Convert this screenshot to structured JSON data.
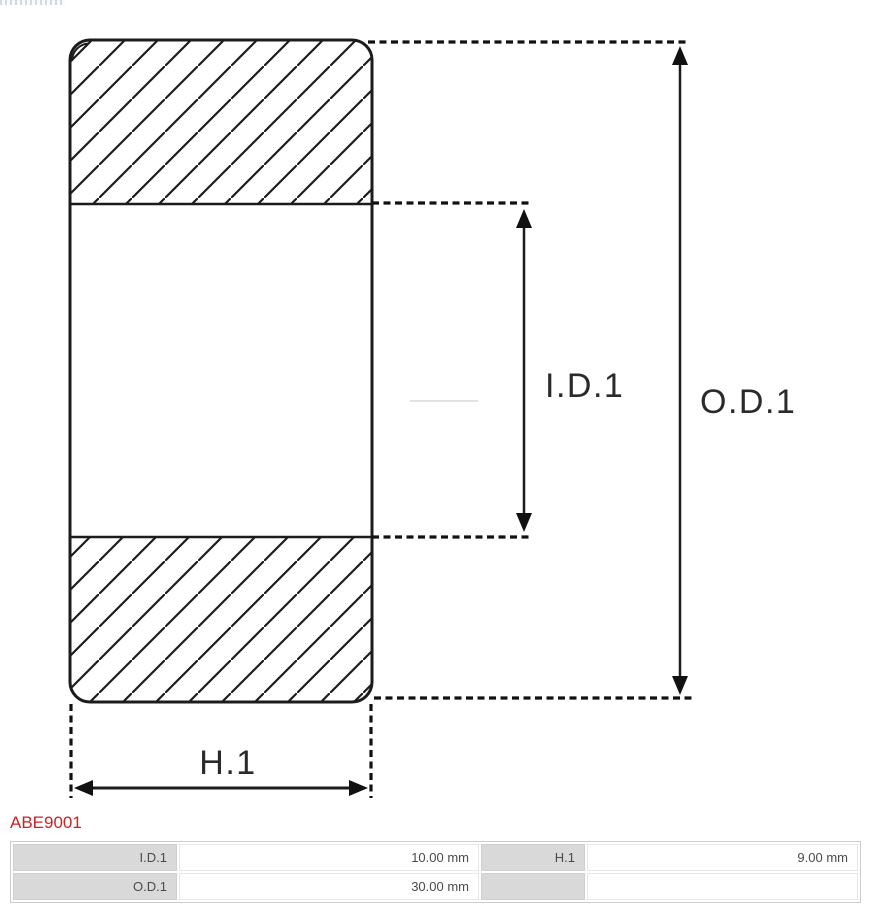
{
  "window": {
    "background": "#ffffff"
  },
  "part_number": {
    "label": "ABE9001",
    "color": "#cc2222"
  },
  "diagram": {
    "kind": "bearing-cross-section",
    "line_color": "#1c1c1c",
    "labels": {
      "id": "I.D.1",
      "od": "O.D.1",
      "h": "H.1"
    }
  },
  "spec_table": {
    "label_bg": "#d9d9d9",
    "rows": [
      {
        "cells": [
          {
            "label": "I.D.1",
            "value": "10.00 mm"
          },
          {
            "label": "H.1",
            "value": "9.00 mm"
          }
        ]
      },
      {
        "cells": [
          {
            "label": "O.D.1",
            "value": "30.00 mm"
          },
          {
            "label": "",
            "value": ""
          }
        ]
      }
    ]
  }
}
